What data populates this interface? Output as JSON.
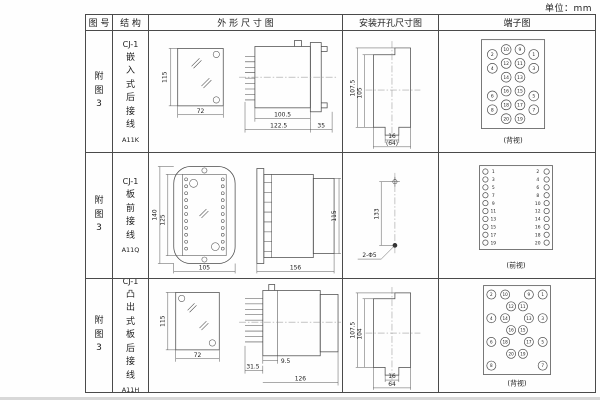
{
  "unit_label": "单位：mm",
  "header": {
    "fig_no": "图 号",
    "structure": "结 构",
    "outline": "外 形 尺 寸 图",
    "mounting": "安装开孔尺寸图",
    "terminal": "端子图"
  },
  "rows": [
    {
      "fig_no": "附图3",
      "model": "CJ-1",
      "structure_desc": "嵌入式后接线",
      "code": "A11K",
      "outline": {
        "front_h": "115",
        "front_w": "72",
        "body_len": "100.5",
        "total_len": "122.5",
        "flange_d": "35"
      },
      "mounting": {
        "outer_h": "107.5",
        "inner_h": "105",
        "notch_w": "16",
        "width": "(64)"
      },
      "terminal": {
        "label": "(背视)",
        "r": 5,
        "font": 4.5,
        "points": [
          {
            "n": "2",
            "cx": 53,
            "cy": 21
          },
          {
            "n": "10",
            "cx": 67,
            "cy": 16
          },
          {
            "n": "9",
            "cx": 81,
            "cy": 16
          },
          {
            "n": "1",
            "cx": 95,
            "cy": 21
          },
          {
            "n": "4",
            "cx": 53,
            "cy": 35
          },
          {
            "n": "12",
            "cx": 67,
            "cy": 30
          },
          {
            "n": "11",
            "cx": 81,
            "cy": 30
          },
          {
            "n": "3",
            "cx": 95,
            "cy": 35
          },
          {
            "n": "14",
            "cx": 67,
            "cy": 44
          },
          {
            "n": "13",
            "cx": 81,
            "cy": 44
          },
          {
            "n": "6",
            "cx": 53,
            "cy": 63
          },
          {
            "n": "16",
            "cx": 67,
            "cy": 58
          },
          {
            "n": "15",
            "cx": 81,
            "cy": 58
          },
          {
            "n": "5",
            "cx": 95,
            "cy": 63
          },
          {
            "n": "8",
            "cx": 53,
            "cy": 77
          },
          {
            "n": "18",
            "cx": 67,
            "cy": 72
          },
          {
            "n": "17",
            "cx": 81,
            "cy": 72
          },
          {
            "n": "7",
            "cx": 95,
            "cy": 77
          },
          {
            "n": "20",
            "cx": 67,
            "cy": 86
          },
          {
            "n": "19",
            "cx": 81,
            "cy": 86
          }
        ]
      }
    },
    {
      "fig_no": "附图3",
      "model": "CJ-1",
      "structure_desc": "板前接线",
      "code": "A11Q",
      "outline": {
        "plate_h": "140",
        "inner_h": "125",
        "plate_w": "105",
        "side_len": "156",
        "side_h": "115"
      },
      "mounting": {
        "hole_spacing": "133",
        "holes": "2-Φ5"
      },
      "terminal": {
        "label": "(前视)",
        "r": 2.7,
        "font": 4.5,
        "points": [
          {
            "n": "1",
            "cx": 46,
            "cy": 15,
            "tx": 54
          },
          {
            "n": "2",
            "cx": 108,
            "cy": 15,
            "tx": 99
          },
          {
            "n": "3",
            "cx": 46,
            "cy": 23,
            "tx": 54
          },
          {
            "n": "4",
            "cx": 108,
            "cy": 23,
            "tx": 99
          },
          {
            "n": "5",
            "cx": 46,
            "cy": 31,
            "tx": 54
          },
          {
            "n": "6",
            "cx": 108,
            "cy": 31,
            "tx": 99
          },
          {
            "n": "7",
            "cx": 46,
            "cy": 39,
            "tx": 54
          },
          {
            "n": "8",
            "cx": 108,
            "cy": 39,
            "tx": 99
          },
          {
            "n": "9",
            "cx": 46,
            "cy": 47,
            "tx": 54
          },
          {
            "n": "10",
            "cx": 108,
            "cy": 47,
            "tx": 99
          },
          {
            "n": "11",
            "cx": 46,
            "cy": 55,
            "tx": 54
          },
          {
            "n": "12",
            "cx": 108,
            "cy": 55,
            "tx": 99
          },
          {
            "n": "13",
            "cx": 46,
            "cy": 63,
            "tx": 54
          },
          {
            "n": "14",
            "cx": 108,
            "cy": 63,
            "tx": 99
          },
          {
            "n": "15",
            "cx": 46,
            "cy": 71,
            "tx": 54
          },
          {
            "n": "16",
            "cx": 108,
            "cy": 71,
            "tx": 99
          },
          {
            "n": "17",
            "cx": 46,
            "cy": 79,
            "tx": 54
          },
          {
            "n": "18",
            "cx": 108,
            "cy": 79,
            "tx": 99
          },
          {
            "n": "19",
            "cx": 46,
            "cy": 87,
            "tx": 54
          },
          {
            "n": "20",
            "cx": 108,
            "cy": 87,
            "tx": 99
          }
        ]
      }
    },
    {
      "fig_no": "附图3",
      "model": "CJ-1",
      "structure_desc": "凸出式板后接线",
      "code": "A11H",
      "outline": {
        "front_h": "115",
        "front_w": "72",
        "pin_len": "31.5",
        "step": "9.5",
        "body_len": "126"
      },
      "mounting": {
        "outer_h": "107.5",
        "inner_h": "104",
        "notch_w": "16",
        "width": "64"
      },
      "terminal": {
        "label": "(背视)",
        "r": 4.6,
        "font": 4.2,
        "points": [
          {
            "n": "2",
            "cx": 52,
            "cy": 14
          },
          {
            "n": "10",
            "cx": 66,
            "cy": 14
          },
          {
            "n": "9",
            "cx": 90,
            "cy": 14
          },
          {
            "n": "1",
            "cx": 104,
            "cy": 14
          },
          {
            "n": "12",
            "cx": 72,
            "cy": 26
          },
          {
            "n": "11",
            "cx": 84,
            "cy": 26
          },
          {
            "n": "4",
            "cx": 52,
            "cy": 38
          },
          {
            "n": "14",
            "cx": 66,
            "cy": 38
          },
          {
            "n": "13",
            "cx": 90,
            "cy": 38
          },
          {
            "n": "3",
            "cx": 104,
            "cy": 38
          },
          {
            "n": "16",
            "cx": 72,
            "cy": 50
          },
          {
            "n": "15",
            "cx": 84,
            "cy": 50
          },
          {
            "n": "6",
            "cx": 52,
            "cy": 62
          },
          {
            "n": "18",
            "cx": 66,
            "cy": 62
          },
          {
            "n": "17",
            "cx": 90,
            "cy": 62
          },
          {
            "n": "5",
            "cx": 104,
            "cy": 62
          },
          {
            "n": "20",
            "cx": 72,
            "cy": 74
          },
          {
            "n": "19",
            "cx": 84,
            "cy": 74
          },
          {
            "n": "8",
            "cx": 52,
            "cy": 86
          },
          {
            "n": "7",
            "cx": 104,
            "cy": 86
          }
        ]
      }
    }
  ]
}
